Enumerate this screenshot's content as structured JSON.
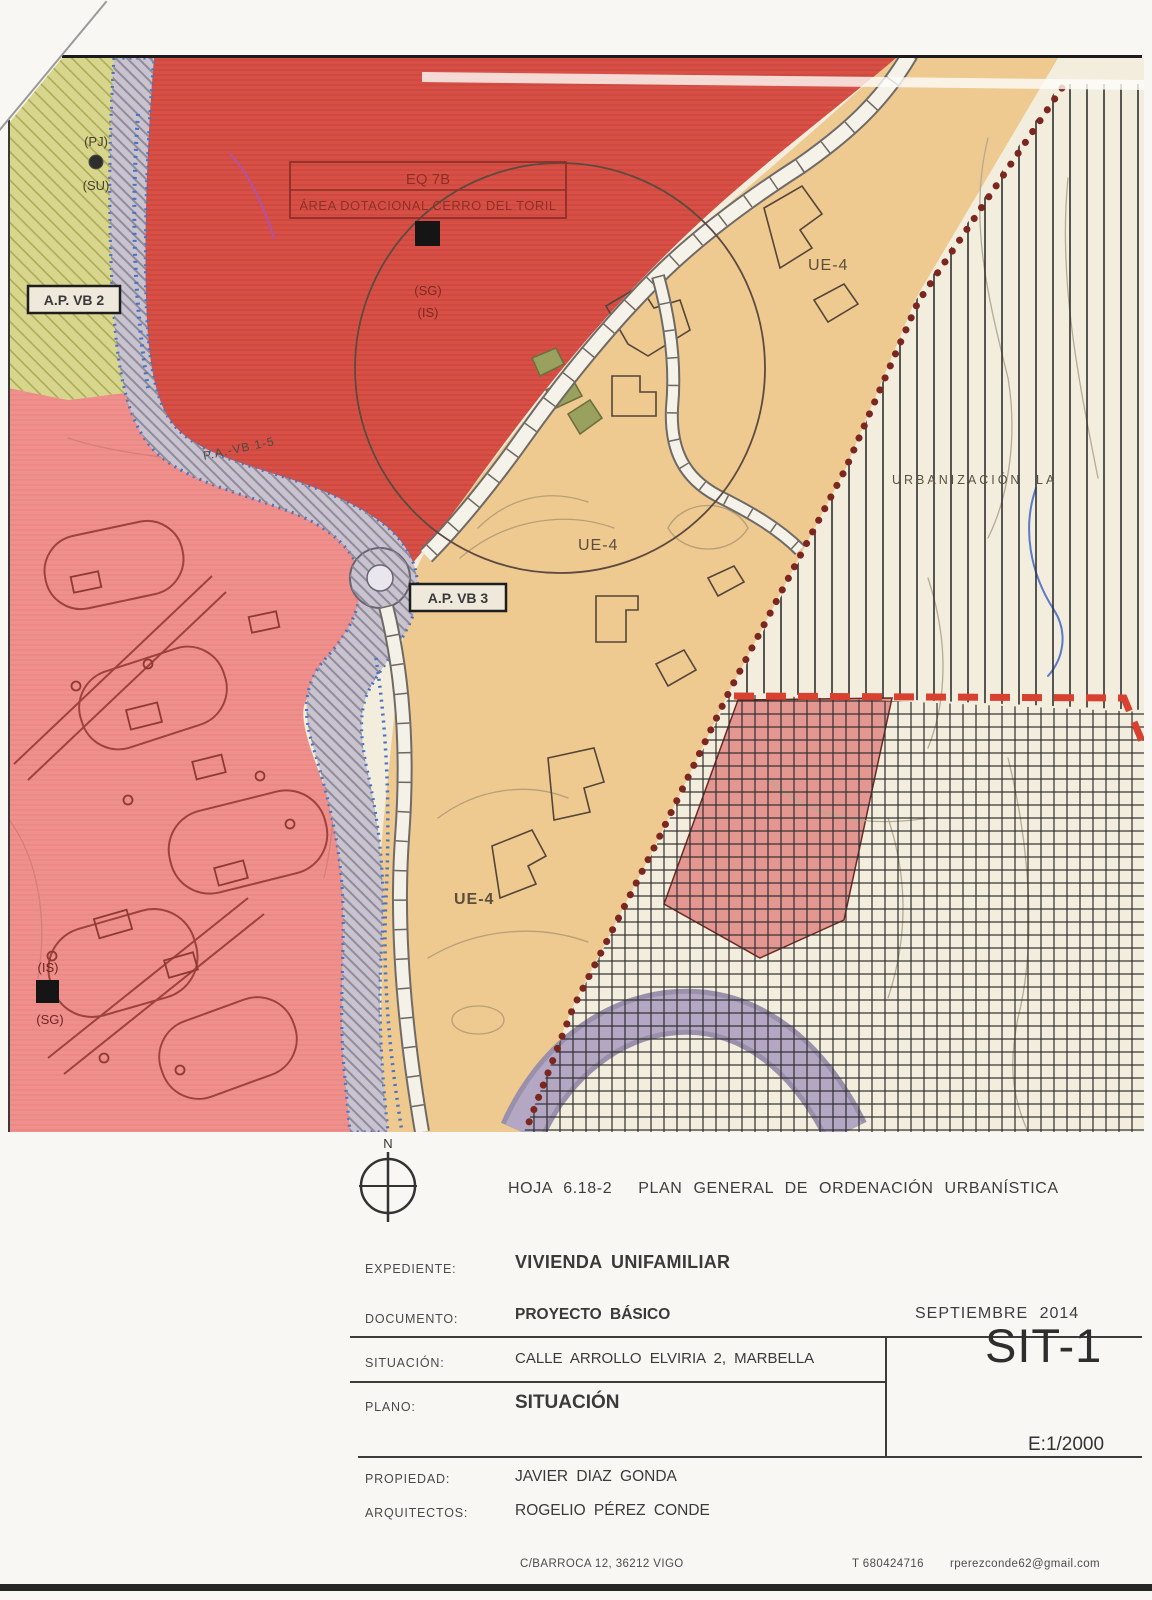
{
  "map": {
    "area_label_box": {
      "line1": "EQ 7B",
      "line2": "ÁREA DOTACIONAL CERRO DEL TORIL"
    },
    "markers": {
      "sg_top": "(SG)",
      "is_top": "(IS)",
      "pj": "(PJ)",
      "su": "(SU)",
      "is_bottom": "(IS)",
      "sg_bottom": "(SG)"
    },
    "boxes": {
      "ap_vb_2": "A.P. VB 2",
      "ap_vb_3": "A.P. VB 3"
    },
    "labels": {
      "ue4": "UE-4",
      "road": "P.A.-VB 1-5",
      "urbanizacion": "URBANIZACIÓN",
      "urbanizacion_la": "LA"
    },
    "compass": {
      "north": "N"
    },
    "colors": {
      "red_zone": "#d85045",
      "pink_zone": "#ef908c",
      "tan_zone": "#eec990",
      "olive_zone": "#d8d68c",
      "cream_zone": "#f2eddc",
      "road_corridor": "#c9c3cf",
      "purple_band": "#b4a7c4",
      "boundary_dashed_red": "#d8402f",
      "boundary_dotted_maroon": "#7c2620",
      "blue_dotted_edge": "#4a72bf"
    }
  },
  "title_block": {
    "header": {
      "sheet_ref": "HOJA  6.18-2",
      "title": "PLAN  GENERAL  DE  ORDENACIÓN  URBANÍSTICA"
    },
    "rows": [
      {
        "label": "EXPEDIENTE:",
        "value": "VIVIENDA UNIFAMILIAR"
      },
      {
        "label": "DOCUMENTO:",
        "value": "PROYECTO  BÁSICO"
      },
      {
        "label": "SITUACIÓN:",
        "value": "CALLE  ARROLLO  ELVIRIA  2,  MARBELLA"
      },
      {
        "label": "PLANO:",
        "value": "SITUACIÓN"
      },
      {
        "label": "PROPIEDAD:",
        "value": "JAVIER  DIAZ  GONDA"
      },
      {
        "label": "ARQUITECTOS:",
        "value": "ROGELIO  PÉREZ  CONDE"
      }
    ],
    "date": "SEPTIEMBRE  2014",
    "sheet_code": "SIT-1",
    "scale": "E:1/2000",
    "footer": {
      "address": "C/BARROCA  12,  36212  VIGO",
      "phone": "T  680424716",
      "email": "rperezconde62@gmail.com"
    }
  }
}
